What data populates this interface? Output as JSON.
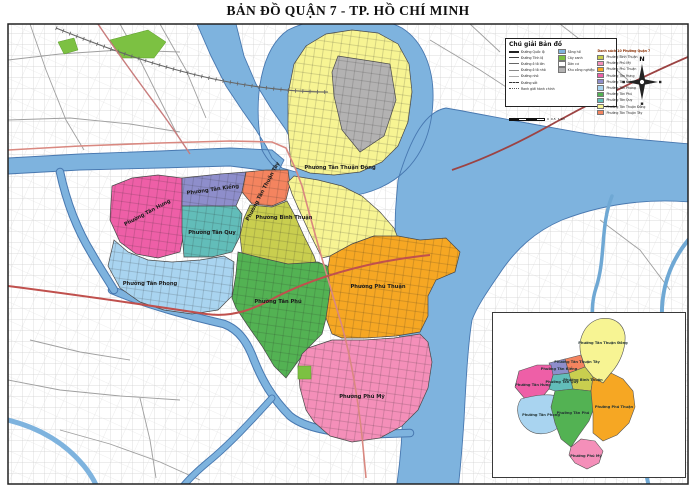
{
  "title": "BẢN ĐỒ QUẬN 7 - TP. HỒ CHÍ MINH",
  "colors": {
    "water": "#7EB3DE",
    "water_edge": "#4878B0",
    "park_green": "#7CC142",
    "industrial_gray": "#B3B2B2",
    "road_national": "#9C4343",
    "road_major": "#C0504D",
    "road_minor": "#D98880"
  },
  "wards": [
    {
      "name": "Phường Bình Thuận",
      "color": "#C9CE4F"
    },
    {
      "name": "Phường Phú Mỹ",
      "color": "#F48FB9"
    },
    {
      "name": "Phường Phú Thuận",
      "color": "#F6A723"
    },
    {
      "name": "Phường Tân Hưng",
      "color": "#EE5FA7"
    },
    {
      "name": "Phường Tân Kiểng",
      "color": "#8E8ECB"
    },
    {
      "name": "Phường Tân Phong",
      "color": "#A9D4F0"
    },
    {
      "name": "Phường Tân Phú",
      "color": "#53B253"
    },
    {
      "name": "Phường Tân Quy",
      "color": "#62BDB9"
    },
    {
      "name": "Phường Tân Thuận Đông",
      "color": "#F7F493"
    },
    {
      "name": "Phường Tân Thuận Tây",
      "color": "#F4845F"
    }
  ],
  "legend": {
    "title": "Chú giải Bản đồ",
    "roads": [
      "Đường Quốc lộ",
      "Đường Tỉnh lộ",
      "Đường ô tô lớn",
      "Đường ô tô nhỏ",
      "Đường nhỏ",
      "Đường sắt",
      "Ranh giới hành chính"
    ],
    "areas": [
      {
        "label": "Sông hồ",
        "color": "#7EB3DE"
      },
      {
        "label": "Cây xanh",
        "color": "#7CC142"
      },
      {
        "label": "Dân cư",
        "color": "#FFFFFF"
      },
      {
        "label": "Khu công nghiệp",
        "color": "#B3B2B2"
      }
    ],
    "ward_list_title": "Danh sách 10 Phường Quận 7",
    "scale": {
      "zero": "0",
      "half": "0,5",
      "one": "1 km"
    }
  },
  "compass": {
    "north": "N"
  }
}
